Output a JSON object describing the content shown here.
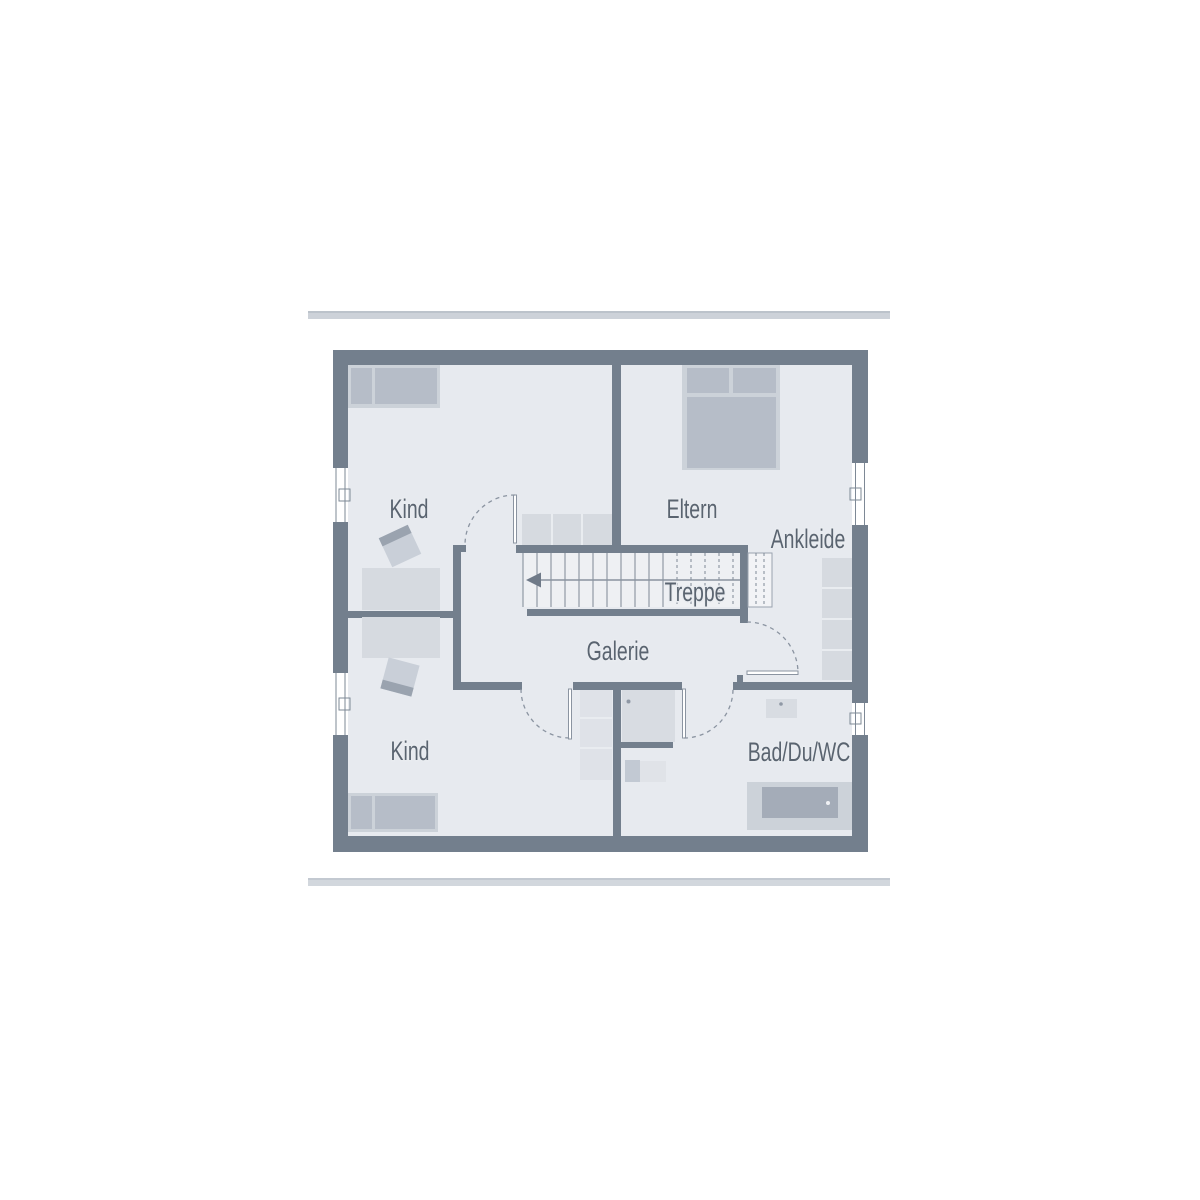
{
  "labels": {
    "kind_top": "Kind",
    "eltern": "Eltern",
    "ankleide": "Ankleide",
    "treppe": "Treppe",
    "galerie": "Galerie",
    "kind_bottom": "Kind",
    "bad": "Bad/Du/WC"
  },
  "colors": {
    "wall": "#737f8d",
    "floor": "#e7eaef",
    "stair_floor": "#eef0f3",
    "furniture_dark": "#b6bdc8",
    "furniture_base": "#ccd2d9",
    "furniture_light": "#d6dae0",
    "fixture": "#d8dce2",
    "tub_inner": "#a4acb8",
    "label_text": "#5a6470",
    "line": "#8b94a1",
    "divider_bar": "#cdd2d9"
  }
}
